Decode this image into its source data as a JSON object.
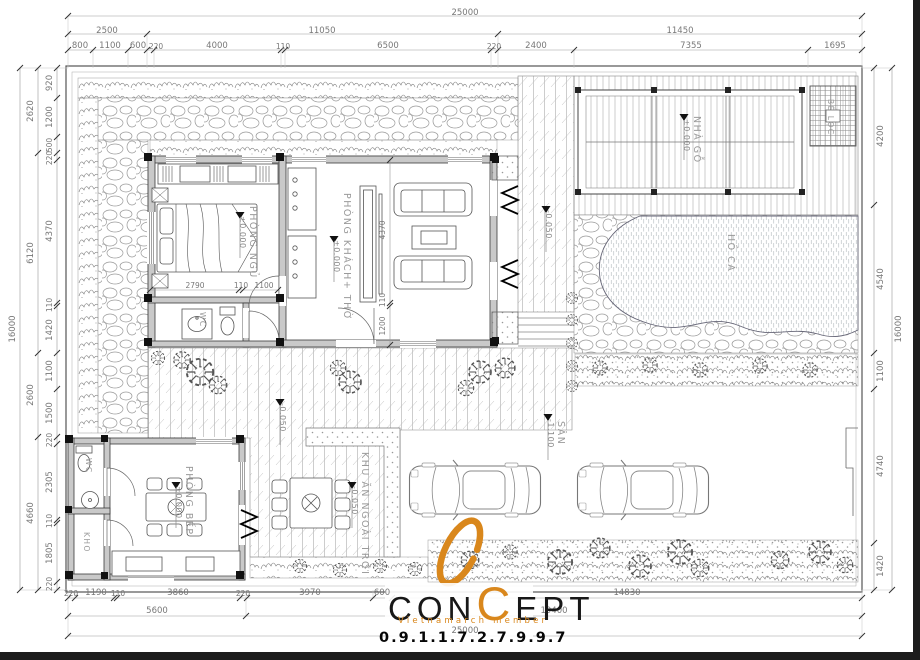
{
  "colors": {
    "accent": "#d9871c",
    "ink": "#333333",
    "dim": "#777777",
    "label": "#9a9a9a"
  },
  "rooms": {
    "bedroom": {
      "name": "PHÒNG NGỦ",
      "level": "±0.000"
    },
    "living": {
      "name": "PHÒNG KHÁCH+ THỜ",
      "level": "±0.000"
    },
    "kitchen": {
      "name": "PHÒNG BẾP",
      "level": "±0.000"
    },
    "wood_house": {
      "name": "NHÀ GỖ",
      "level": "±0.000"
    },
    "fish_pond": {
      "name": "HỒ CÁ"
    },
    "filter_tank": {
      "name": "BỂ LỌC"
    },
    "yard": {
      "name": "SÂN",
      "level": "-1.100"
    },
    "outdoor_dining": {
      "name": "KHU ĂN NGOÀI TRỜI",
      "level": "-0.050"
    },
    "wc_house": {
      "name": "WC"
    },
    "wc_kitchen": {
      "name": "WC"
    },
    "storage": {
      "name": "KHO"
    },
    "veranda_level": "-0.050",
    "terrace_level": "-0.050"
  },
  "dims": {
    "top": {
      "total": "25000",
      "groups": [
        "2500",
        "11050",
        "11450"
      ],
      "segs": [
        "800",
        "1100",
        "600",
        "220",
        "4000",
        "110",
        "6500",
        "220",
        "2400",
        "7355",
        "1695"
      ]
    },
    "bottom": {
      "total": "25000",
      "groups": [
        "5600",
        "19400"
      ],
      "segs": [
        "220",
        "1190",
        "110",
        "3860",
        "220",
        "3970",
        "600",
        "14830"
      ]
    },
    "left": {
      "total": "16000",
      "groups": [
        "2620",
        "6120",
        "2600",
        "4660"
      ],
      "segs": [
        "920",
        "1200",
        "500",
        "220",
        "4370",
        "110",
        "1420",
        "1100",
        "1500",
        "220",
        "2305",
        "110",
        "1805",
        "220"
      ]
    },
    "right": {
      "total": "16000",
      "segs": [
        "4200",
        "4540",
        "1100",
        "4740",
        "1420"
      ]
    },
    "bedroom_segs": [
      "2790",
      "110",
      "1100"
    ],
    "living_segs": [
      "4370",
      "110",
      "1200"
    ]
  },
  "logo": {
    "brand_start": "CON",
    "brand_accent": "C",
    "brand_end": "EPT",
    "subtitle": "Vietnamarch member",
    "phone": "0.9.1.1.7.2.7.9.9.7"
  }
}
